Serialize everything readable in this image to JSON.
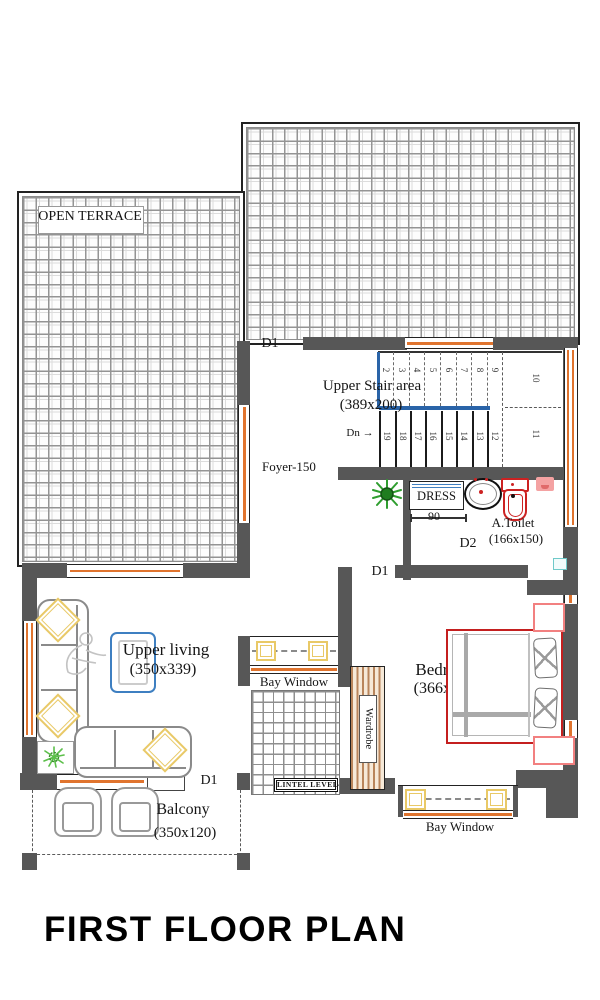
{
  "title": "FIRST FLOOR PLAN",
  "terrace": {
    "label": "OPEN TERRACE"
  },
  "stair": {
    "name": "Upper Stair area",
    "size": "(389x200)",
    "down": "Dn →",
    "upper": [
      "2",
      "3",
      "4",
      "5",
      "6",
      "7",
      "8",
      "9"
    ],
    "upper_landing": "10",
    "lower": [
      "19",
      "18",
      "17",
      "16",
      "15",
      "14",
      "13",
      "12"
    ],
    "lower_landing": "11"
  },
  "foyer": {
    "label": "Foyer-150"
  },
  "dress": {
    "label": "DRESS",
    "width_dim": "90"
  },
  "toilet": {
    "label": "A.Toilet",
    "size": "(166x150)"
  },
  "living": {
    "label": "Upper living",
    "size": "(350x339)"
  },
  "bedroom": {
    "label": "Bedroom",
    "size": "(366x350)"
  },
  "balcony": {
    "label": "Balcony",
    "size": "(350x120)"
  },
  "bays": {
    "left_label": "Bay Window",
    "bottom_label": "Bay Window",
    "lintel": "LINTEL LEVEL"
  },
  "wardrobe": {
    "label": "Wardrobe"
  },
  "doors": {
    "d1": "D1",
    "d2": "D2"
  },
  "colors": {
    "wall": "#575757",
    "window_frame": "#e0742e",
    "handrail": "#2a64a8",
    "bed_outline": "#c41f1f",
    "fixture_red": "#cc2222",
    "accent_yellow": "#e9c967",
    "wardrobe_tan": "#b9855b",
    "plant_green": "#2f9e2f",
    "table_blue": "#3e7fc1",
    "niche_teal": "#6fc9c9",
    "shower_pink": "#f4a2a2"
  }
}
